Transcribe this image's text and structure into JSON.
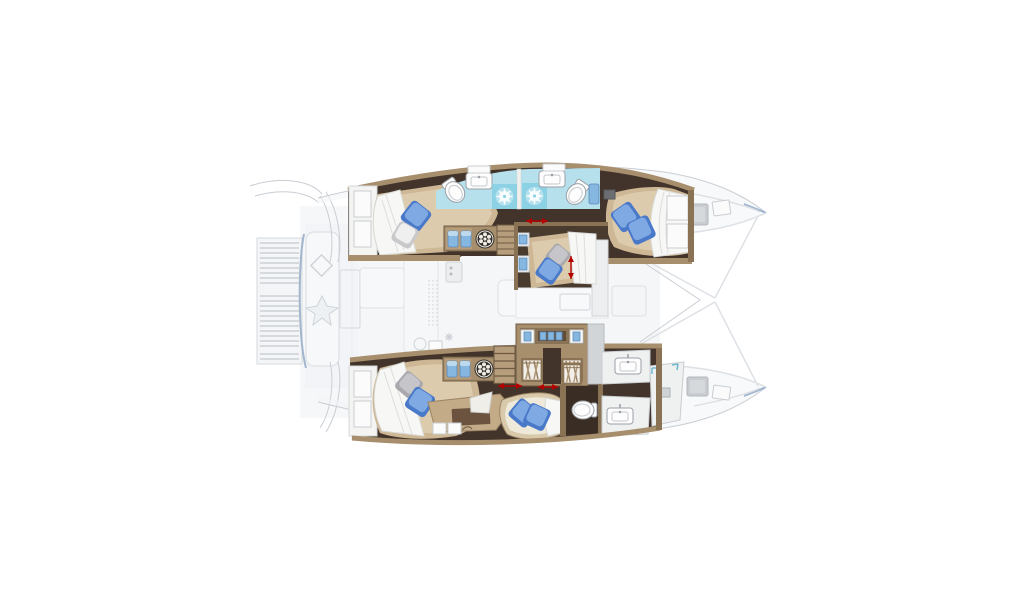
{
  "figure": {
    "type": "catamaran-floor-plan",
    "view": "top-down-lower-deck",
    "orientation": {
      "bow": "right",
      "stern": "left"
    },
    "highlighted_areas": "hull accommodation (cabins, bathrooms) and forward center cabin shown in full color",
    "faded_areas": [
      "stern platform with teak grating",
      "aft cockpit bench",
      "saloon and galley",
      "foredeck and bow lockers",
      "bow tips"
    ],
    "rooms": [
      {
        "id": "starboard-aft-cabin",
        "features": [
          "double-bed",
          "blue-pillow",
          "white-pillow",
          "duvet",
          "transom-step-shelves"
        ]
      },
      {
        "id": "starboard-bathrooms",
        "features": [
          "toilet",
          "washbasin",
          "shower",
          "shower",
          "washbasin",
          "toilet",
          "blue-locker"
        ]
      },
      {
        "id": "starboard-corridor",
        "features": [
          "towel-lockers",
          "washing-machine",
          "companionway-stairs",
          "door-arrow"
        ]
      },
      {
        "id": "starboard-forward-cabin",
        "features": [
          "double-bed",
          "two-blue-pillows",
          "duvet",
          "shelves"
        ]
      },
      {
        "id": "center-forward-cabin",
        "features": [
          "double-bed",
          "blue-pillow",
          "gray-pillow",
          "duvet",
          "width-arrow",
          "wall-shelves",
          "steps"
        ]
      },
      {
        "id": "port-aft-cabin",
        "features": [
          "double-bed",
          "blue-pillow",
          "gray-pillow",
          "duvet",
          "transom-step-shelves"
        ]
      },
      {
        "id": "port-corridor",
        "features": [
          "towel-lockers",
          "washing-machine",
          "companionway-stairs",
          "wardrobes",
          "door-arrows"
        ]
      },
      {
        "id": "port-desk-area",
        "features": [
          "desk",
          "desk-mat",
          "chair",
          "drawers"
        ]
      },
      {
        "id": "port-lounge-berth",
        "features": [
          "chaise",
          "two-blue-pillows"
        ]
      },
      {
        "id": "port-forward-bathroom",
        "features": [
          "toilet",
          "washbasin",
          "washbasin",
          "shower",
          "hanging-lockers"
        ]
      }
    ]
  },
  "colors": {
    "background": "#ffffff",
    "floor_dark_wood": "#42342a",
    "cabinet_wood": "#a78e6c",
    "cabinet_wood_dark": "#8a7254",
    "cabinet_wood_light": "#c0a885",
    "bed_mattress": "#cdb795",
    "bed_mattress_light": "#dccbad",
    "duvet_white": "#f7f7f5",
    "pillow_blue": "#4a79c9",
    "pillow_blue_light": "#7fa9e2",
    "pillow_gray": "#c6c6ca",
    "bathroom_floor": "#b5e0ec",
    "shower_tile": "#8dd2e4",
    "fixture_white": "#fdfdfd",
    "fixture_outline": "#9aa0a6",
    "accent_red": "#b40000",
    "faded_fill": "#f2f4f6",
    "faded_line": "#dde1e5",
    "faded_line_dark": "#c9ced4",
    "hull_edge_blue": "#93aac8",
    "towel_blue": "#86b7e0",
    "washer_dark": "#312d28"
  }
}
